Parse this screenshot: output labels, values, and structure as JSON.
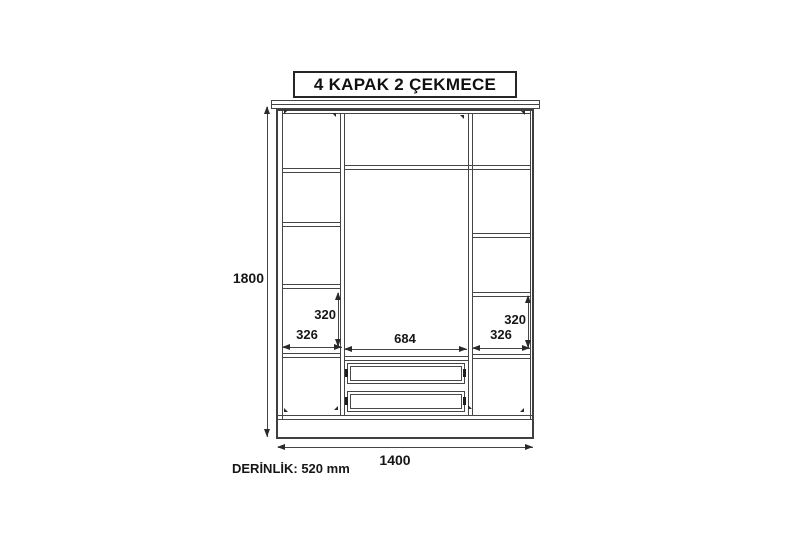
{
  "title": "4 KAPAK 2 ÇEKMECE",
  "annotations": {
    "overall_height_mm": "1800",
    "overall_width_mm": "1400",
    "left_section": {
      "inner_height_mm": "320",
      "inner_width_mm": "326"
    },
    "center_section": {
      "inner_width_mm": "684"
    },
    "right_section": {
      "inner_height_mm": "320",
      "inner_width_mm": "326"
    },
    "depth_label": "DERİNLİK: 520 mm"
  },
  "drawing": {
    "type": "furniture front elevation",
    "doors": 4,
    "drawers": 2,
    "left_column_compartments": 5,
    "right_column_compartments": 5
  },
  "colors": {
    "background": "#ffffff",
    "line": "#454545",
    "text": "#161616"
  }
}
